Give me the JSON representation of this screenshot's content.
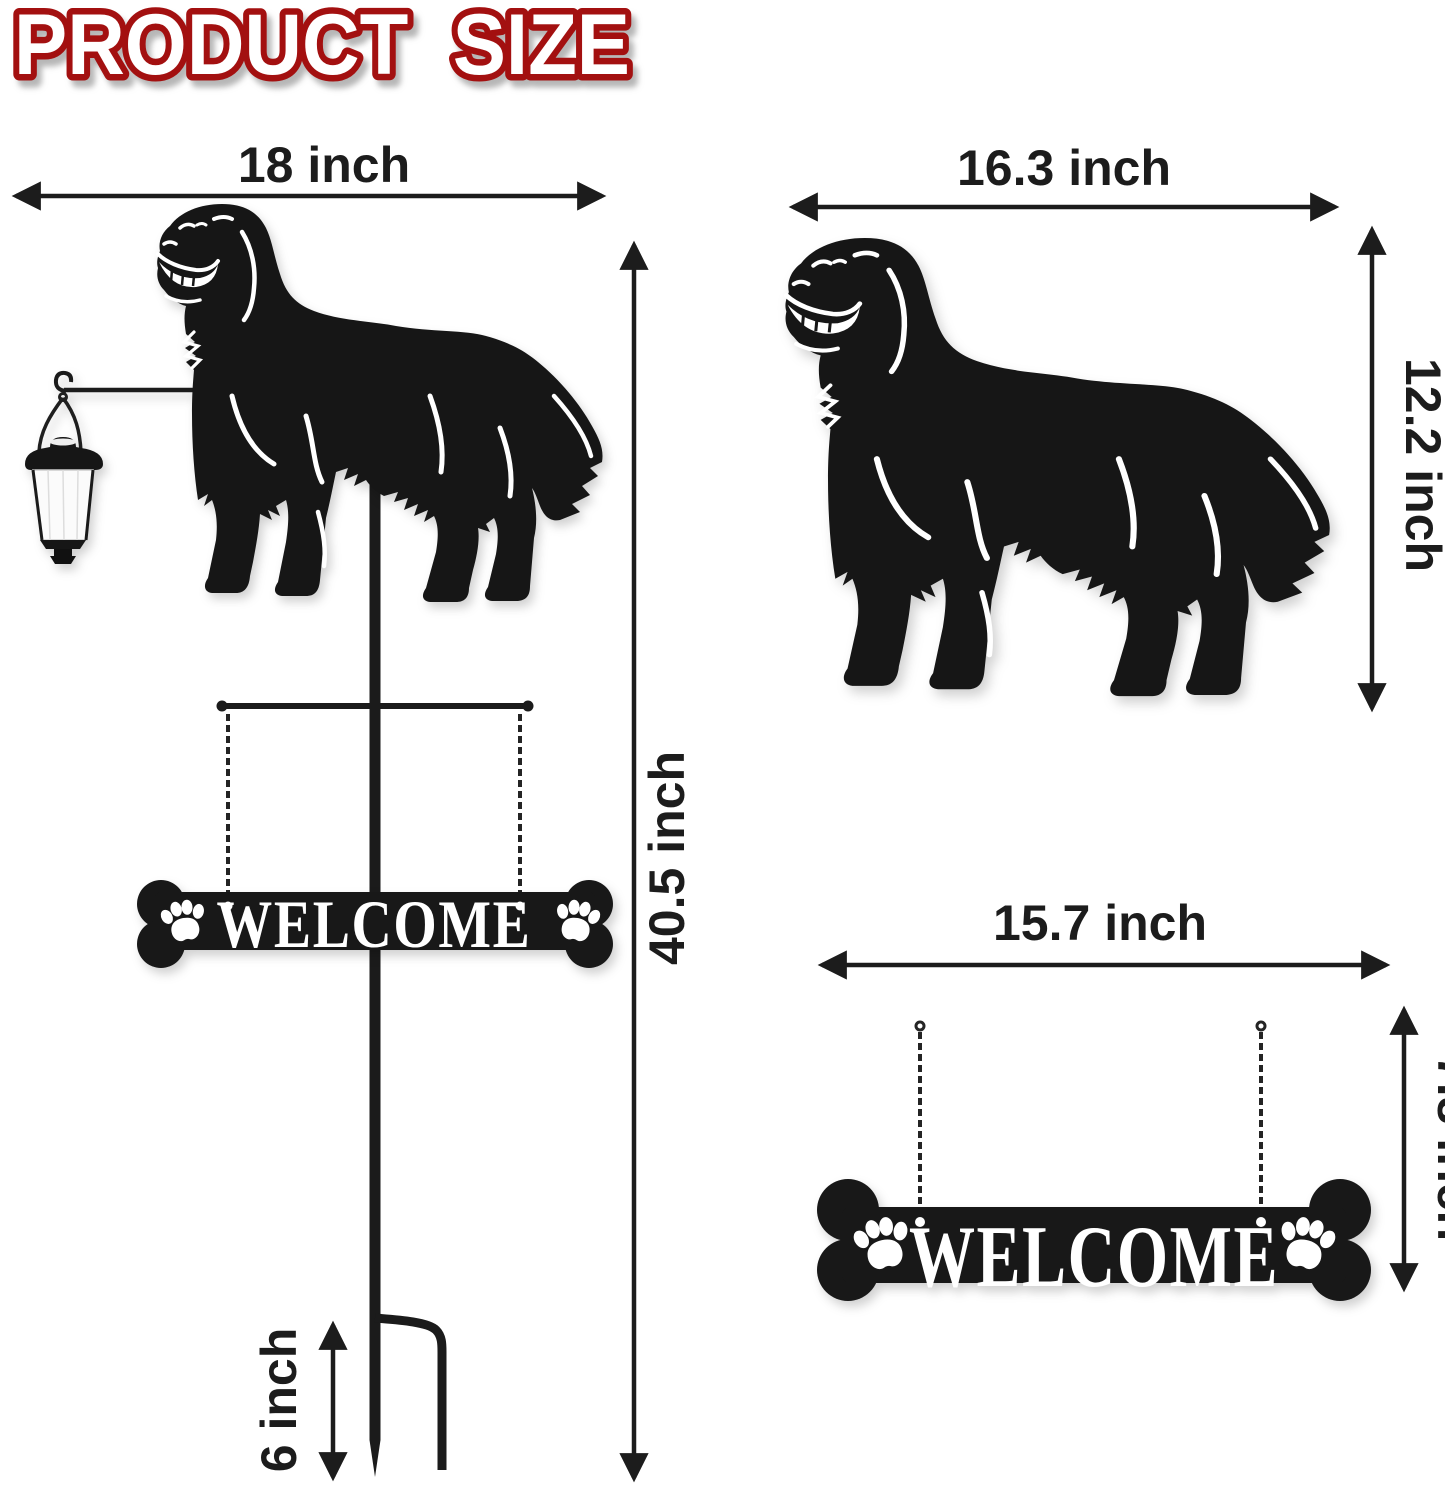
{
  "title": "PRODUCT SIZE",
  "unit": "inch",
  "colors": {
    "background": "#ffffff",
    "silhouette_black": "#161616",
    "title_fill": "#ffffff",
    "title_outline": "#a31010",
    "dimension_color": "#1c1c1c",
    "sign_letters": "#ffffff",
    "lantern_body": "#fbfbfb"
  },
  "left_figure": {
    "description": "dog garden stake with solar lantern and hanging welcome sign",
    "width_label": "18 inch",
    "height_label": "40.5 inch",
    "stake_label": "6 inch",
    "sign_text": "WELCOME",
    "width_in": 18,
    "height_in": 40.5,
    "stake_in": 6
  },
  "dog_figure": {
    "description": "dog silhouette panel",
    "width_label": "16.3 inch",
    "height_label": "12.2 inch",
    "width_in": 16.3,
    "height_in": 12.2
  },
  "sign_figure": {
    "description": "hanging bone welcome sign",
    "width_label": "15.7 inch",
    "height_label": "7.8 inch",
    "sign_text": "WELCOME",
    "width_in": 15.7,
    "height_in": 7.8
  }
}
